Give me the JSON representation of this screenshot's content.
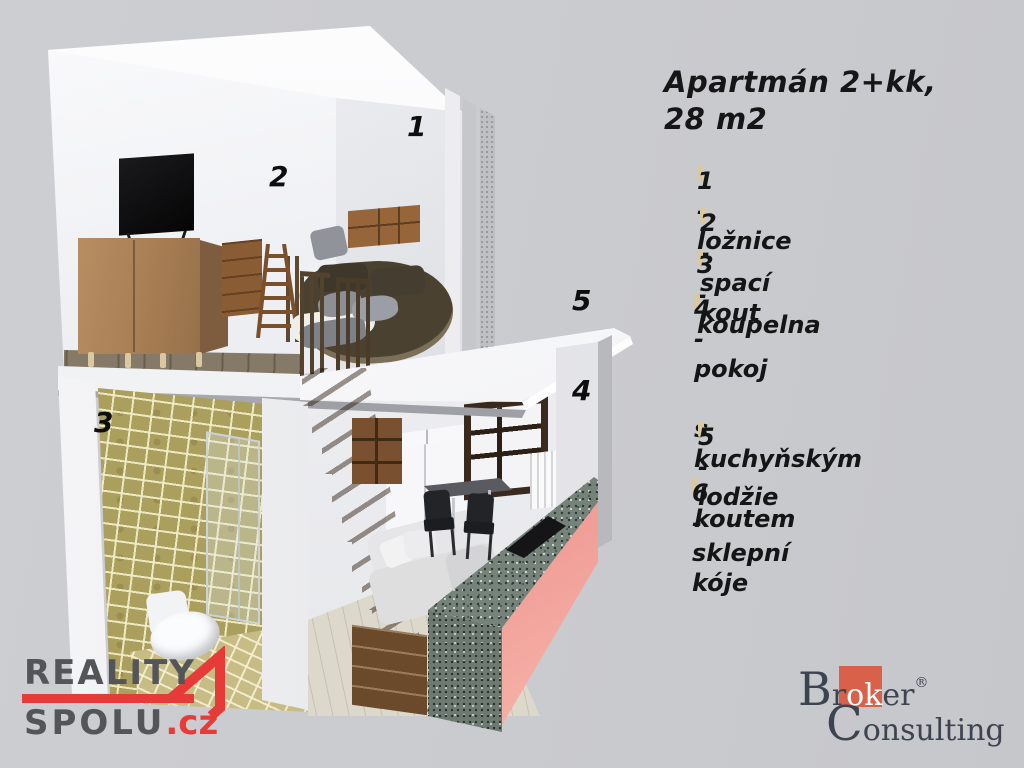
{
  "title": {
    "line1": "Apartmán 2+kk,",
    "line2": "28 m2"
  },
  "legend": {
    "items": [
      {
        "label": "1 - ložnice"
      },
      {
        "label": "2 - spací kout"
      },
      {
        "label": "3 - koupelna"
      },
      {
        "label": "4 - pokoj\n     s  kuchyňským\n     koutem"
      },
      {
        "label": "5 - lodžie"
      },
      {
        "label": "6 - sklepní kóje"
      }
    ]
  },
  "render": {
    "room_labels": [
      {
        "text": "1"
      },
      {
        "text": "2"
      },
      {
        "text": "3"
      },
      {
        "text": "4"
      },
      {
        "text": "5"
      }
    ]
  },
  "logos": {
    "reality": {
      "line1": "REALITY",
      "line2": "SPOLU",
      "tld": ".cz"
    },
    "broker": {
      "initial1": "B",
      "seg1": "r",
      "highlight": "ok",
      "seg2": "er",
      "registered": "®",
      "initial2": "C",
      "seg3": "onsulting"
    }
  },
  "colors": {
    "background": "#cbccd0",
    "legend_text": "#151515",
    "reality_gray": "#545559",
    "reality_red": "#e73b3a",
    "broker_orange": "#d9614a",
    "broker_text": "#3d4450",
    "counter_glow": "#e8837e",
    "tile_olive": "#ab9f5e"
  }
}
